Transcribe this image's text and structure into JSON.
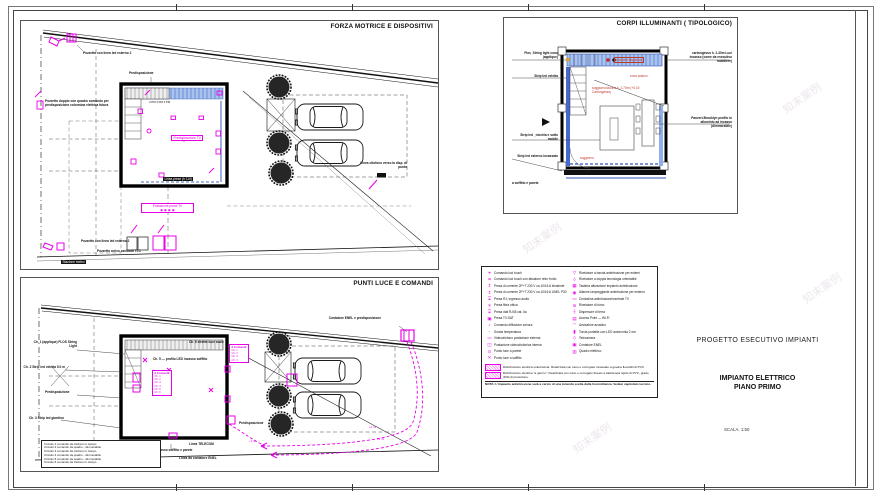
{
  "sheet": {
    "watermark": "知末案例"
  },
  "colors": {
    "accent_magenta": "#e800e8",
    "strip_blue": "#7ea0e8",
    "room_red": "#c0392b"
  },
  "panel_forza": {
    "title": "FORZA MOTRICE E DISPOSITIVI",
    "pozzetto_led_top": "Pozzetto con linea led esterno 2",
    "predisposizione": "Predisposizione",
    "pozzetto_colonnina": "Pozzetto doppio con quadro comando per predisposizione colonnina elettrica futura",
    "dim_text": "4 PM    4 PM    4 PM",
    "predisp_tv": "Predisposizione TV",
    "linea_label": "Linea prese (h 110)",
    "postazione": "Postazione prese TV",
    "postazione_syms": "▣ ▣ ▣ ▣",
    "pozzetto_led_bottom": "Pozzetto con linea led esterno 2",
    "pozzetto_tlc": "Pozzetto arrivo cavidotti TLC",
    "stazione_meteo": "Stazione meteo",
    "linea_citofono": "Linea citofono verso la disp. di punto"
  },
  "panel_corpi": {
    "title": "CORPI ILLUMINANTI ( TIPOLOGICO)",
    "left1": "Flos_String light cono (applique)",
    "left2": "Strip led veletta",
    "left3": "Strip led _nicchia e sotto mobile",
    "left4": "Strip led esterno incassato",
    "foot": "a soffitto e parete",
    "right1": "cartongesso h. 2.40m Luci incasso (come da esecutivo mobiliere)",
    "right2": "Panzeri-Brooklyn profilo in alluminio ad incasso (dimmerabile)",
    "room1": "cucina e dispensa",
    "room2": "zona pranzo",
    "room3": "soggiorno/cucina h. 2.70m (+0.15 Cartongesso)",
    "room4": "soggiorno"
  },
  "panel_punti": {
    "title": "PUNTI LUCE E COMANDI",
    "contatore": "Contatore ENEL e predisposizione",
    "ch1": "Ch. 1 (applique) FLOS String Light",
    "ch2": "Ch. 2 Strip led veletta 5.0 m",
    "predisposizione_l": "Predisposizione",
    "predisposizione_r": "Predisposizione",
    "ch3": "Ch. 3 Strip led giardino",
    "ch4": "Ch. 4 Strip led esterno — incasso soffitto e parete",
    "ch5": "Ch. 5 — profilo LED incasso soffitto",
    "ch6": "Ch. 6 diretto luce scale",
    "comandi_title": "6 Comandi",
    "comandi": [
      "Ch. 1",
      "Ch. 2",
      "Ch. 3",
      "Ch. 4",
      "Ch. 5",
      "Ch. 6"
    ],
    "side_list_title": "6 Comandi",
    "side_list": [
      "Ch. 1",
      "Ch. 2",
      "Ch. 3",
      "Ch. 4"
    ],
    "linea_telecom": "Linea TELECOM",
    "linea_enel": "Linea da contatore ENEL",
    "plus1": "+1 mt",
    "note_lines": [
      "Circuito 1 comando da citofono in campo",
      "Circuito 2 comando da quadro - dimmerabile",
      "Circuito 3 comando da citofono in campo",
      "Circuito 4 comando da quadro - dimmerabile",
      "Circuito 5 comando da quadro - dimmerabile",
      "Circuito 6 comando da citofono in campo"
    ]
  },
  "legend": {
    "left": [
      {
        "sym": "⌖",
        "text": "Comando luci touch"
      },
      {
        "sym": "⌗",
        "text": "Comando luci touch con attuatore retro frutto"
      },
      {
        "sym": "↥",
        "text": "Presa di corrente 2P+T 230 V ca 10/16 A bivalente"
      },
      {
        "sym": "↥",
        "text": "Presa di corrente 2P+T 230 V ca 10/16 A UNEL P30"
      },
      {
        "sym": "⌻",
        "text": "Presa RJ; ingresso audio"
      },
      {
        "sym": "⌾",
        "text": "Presa fibra ottica"
      },
      {
        "sym": "⌻",
        "text": "Presa dati RJ45 cat. 6a"
      },
      {
        "sym": "▣",
        "text": "Presa TV-SAT"
      },
      {
        "sym": "♪",
        "text": "Comando diffusione sonora"
      },
      {
        "sym": "◦",
        "text": "Sonda temperatura"
      },
      {
        "sym": "▭",
        "text": "Videocitofono postazione esterna"
      },
      {
        "sym": "◫",
        "text": "Postazione videocitofonica interna"
      },
      {
        "sym": "⊙",
        "text": "Punto luce a parete"
      },
      {
        "sym": "✕",
        "text": "Punto luce a soffitto"
      }
    ],
    "right": [
      {
        "sym": "▽",
        "text": "Rivelatore a banda antintrusione per esterni"
      },
      {
        "sym": "◊",
        "text": "Rivelatore a doppia tecnologia orientabile"
      },
      {
        "sym": "▦",
        "text": "Tastiera attivazione impianto antintrusione"
      },
      {
        "sym": "◉",
        "text": "Allarme lampeggiante antintrusione per esterno"
      },
      {
        "sym": "▭",
        "text": "Centralina antintrusione/centrale TV"
      },
      {
        "sym": "⊚",
        "text": "Rivelatore di fumo"
      },
      {
        "sym": "⏚",
        "text": "Dispersore di terra"
      },
      {
        "sym": "▤",
        "text": "Access Point — Wi-Fi"
      },
      {
        "sym": "◠",
        "text": "Avvisatore acustico"
      },
      {
        "sym": "▮",
        "text": "Torcia portatile con LED autonomia 2 ore"
      },
      {
        "sym": "◇",
        "text": "Telecamera"
      },
      {
        "sym": "▣",
        "text": "Contatore ENEL"
      },
      {
        "sym": "▥",
        "text": "Quadro elettrico"
      }
    ],
    "wide": [
      {
        "text": "Distribuzione elettrica sottotraccia. Realizzata con cavo e corrugato incassato a guaina flessibili di PVC."
      },
      {
        "text": "Distribuzione elettrica \"a giorno\". Realizzata con cavo e corrugato fissato a battiscopa rigido di PVC, grado IP40 di protezione."
      }
    ],
    "nota": "NOTA: L'impianto antintrusione sarà a carico di una Azienda scelta dalla Committenza. Vedasi capitolato tecnico."
  },
  "titleblock": {
    "line1": "PROGETTO ESECUTIVO IMPIANTI",
    "line2": "IMPIANTO ELETTRICO",
    "line3": "PIANO PRIMO",
    "scale": "SCALA:  1:50"
  }
}
